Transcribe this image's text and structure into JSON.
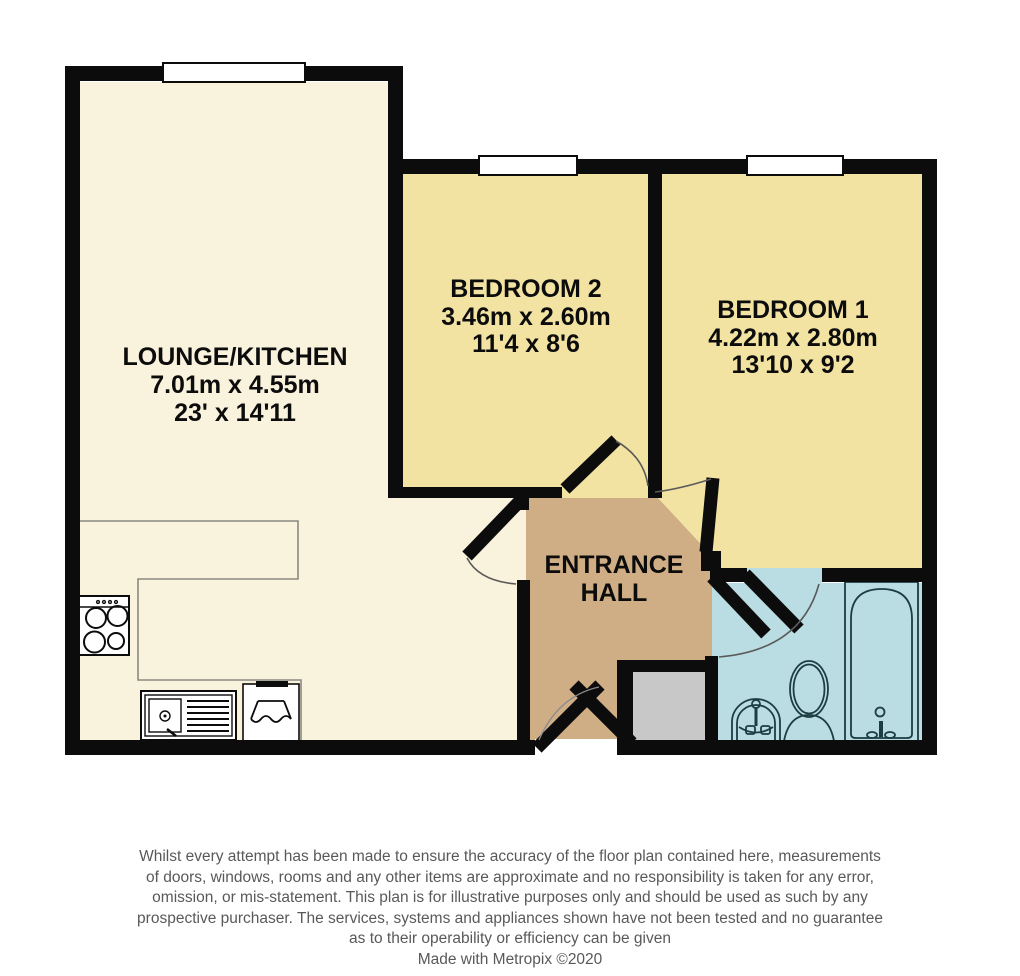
{
  "plan": {
    "rooms": {
      "lounge_kitchen": {
        "name": "LOUNGE/KITCHEN",
        "metric": "7.01m x 4.55m",
        "imperial": "23' x 14'11"
      },
      "bedroom_2": {
        "name": "BEDROOM 2",
        "metric": "3.46m x 2.60m",
        "imperial": "11'4 x 8'6"
      },
      "bedroom_1": {
        "name": "BEDROOM 1",
        "metric": "4.22m x 2.80m",
        "imperial": "13'10 x 9'2"
      },
      "entrance_hall": {
        "line1": "ENTRANCE",
        "line2": "HALL"
      }
    },
    "fixtures": [
      "hob",
      "kitchen-sink-drainer",
      "oven",
      "bath",
      "toilet",
      "wash-basin",
      "storage-cupboard"
    ],
    "colors": {
      "wall": "#0c0c0c",
      "lounge_floor": "#f9f2dc",
      "bedroom_floor": "#f2e3a3",
      "hall_floor": "#cfae85",
      "bathroom_floor": "#b9dde2",
      "cupboard_floor": "#c8c8c8",
      "fixture_outline": "#1c3d42",
      "counter_outline": "#8a8a80",
      "door_arc": "#5a5a5a",
      "footer_text": "#58595b"
    }
  },
  "footer": {
    "disclaimer_lines": [
      "Whilst every attempt has been made to ensure the accuracy of the floor plan contained here, measurements",
      "of doors, windows, rooms and any other items are approximate and no responsibility is taken for any error,",
      "omission, or mis-statement. This plan is for illustrative purposes only and should be used as such by any",
      "prospective purchaser. The services, systems and appliances shown have not been tested and no guarantee",
      "as to their operability or efficiency can be given"
    ],
    "credit": "Made with Metropix ©2020"
  }
}
